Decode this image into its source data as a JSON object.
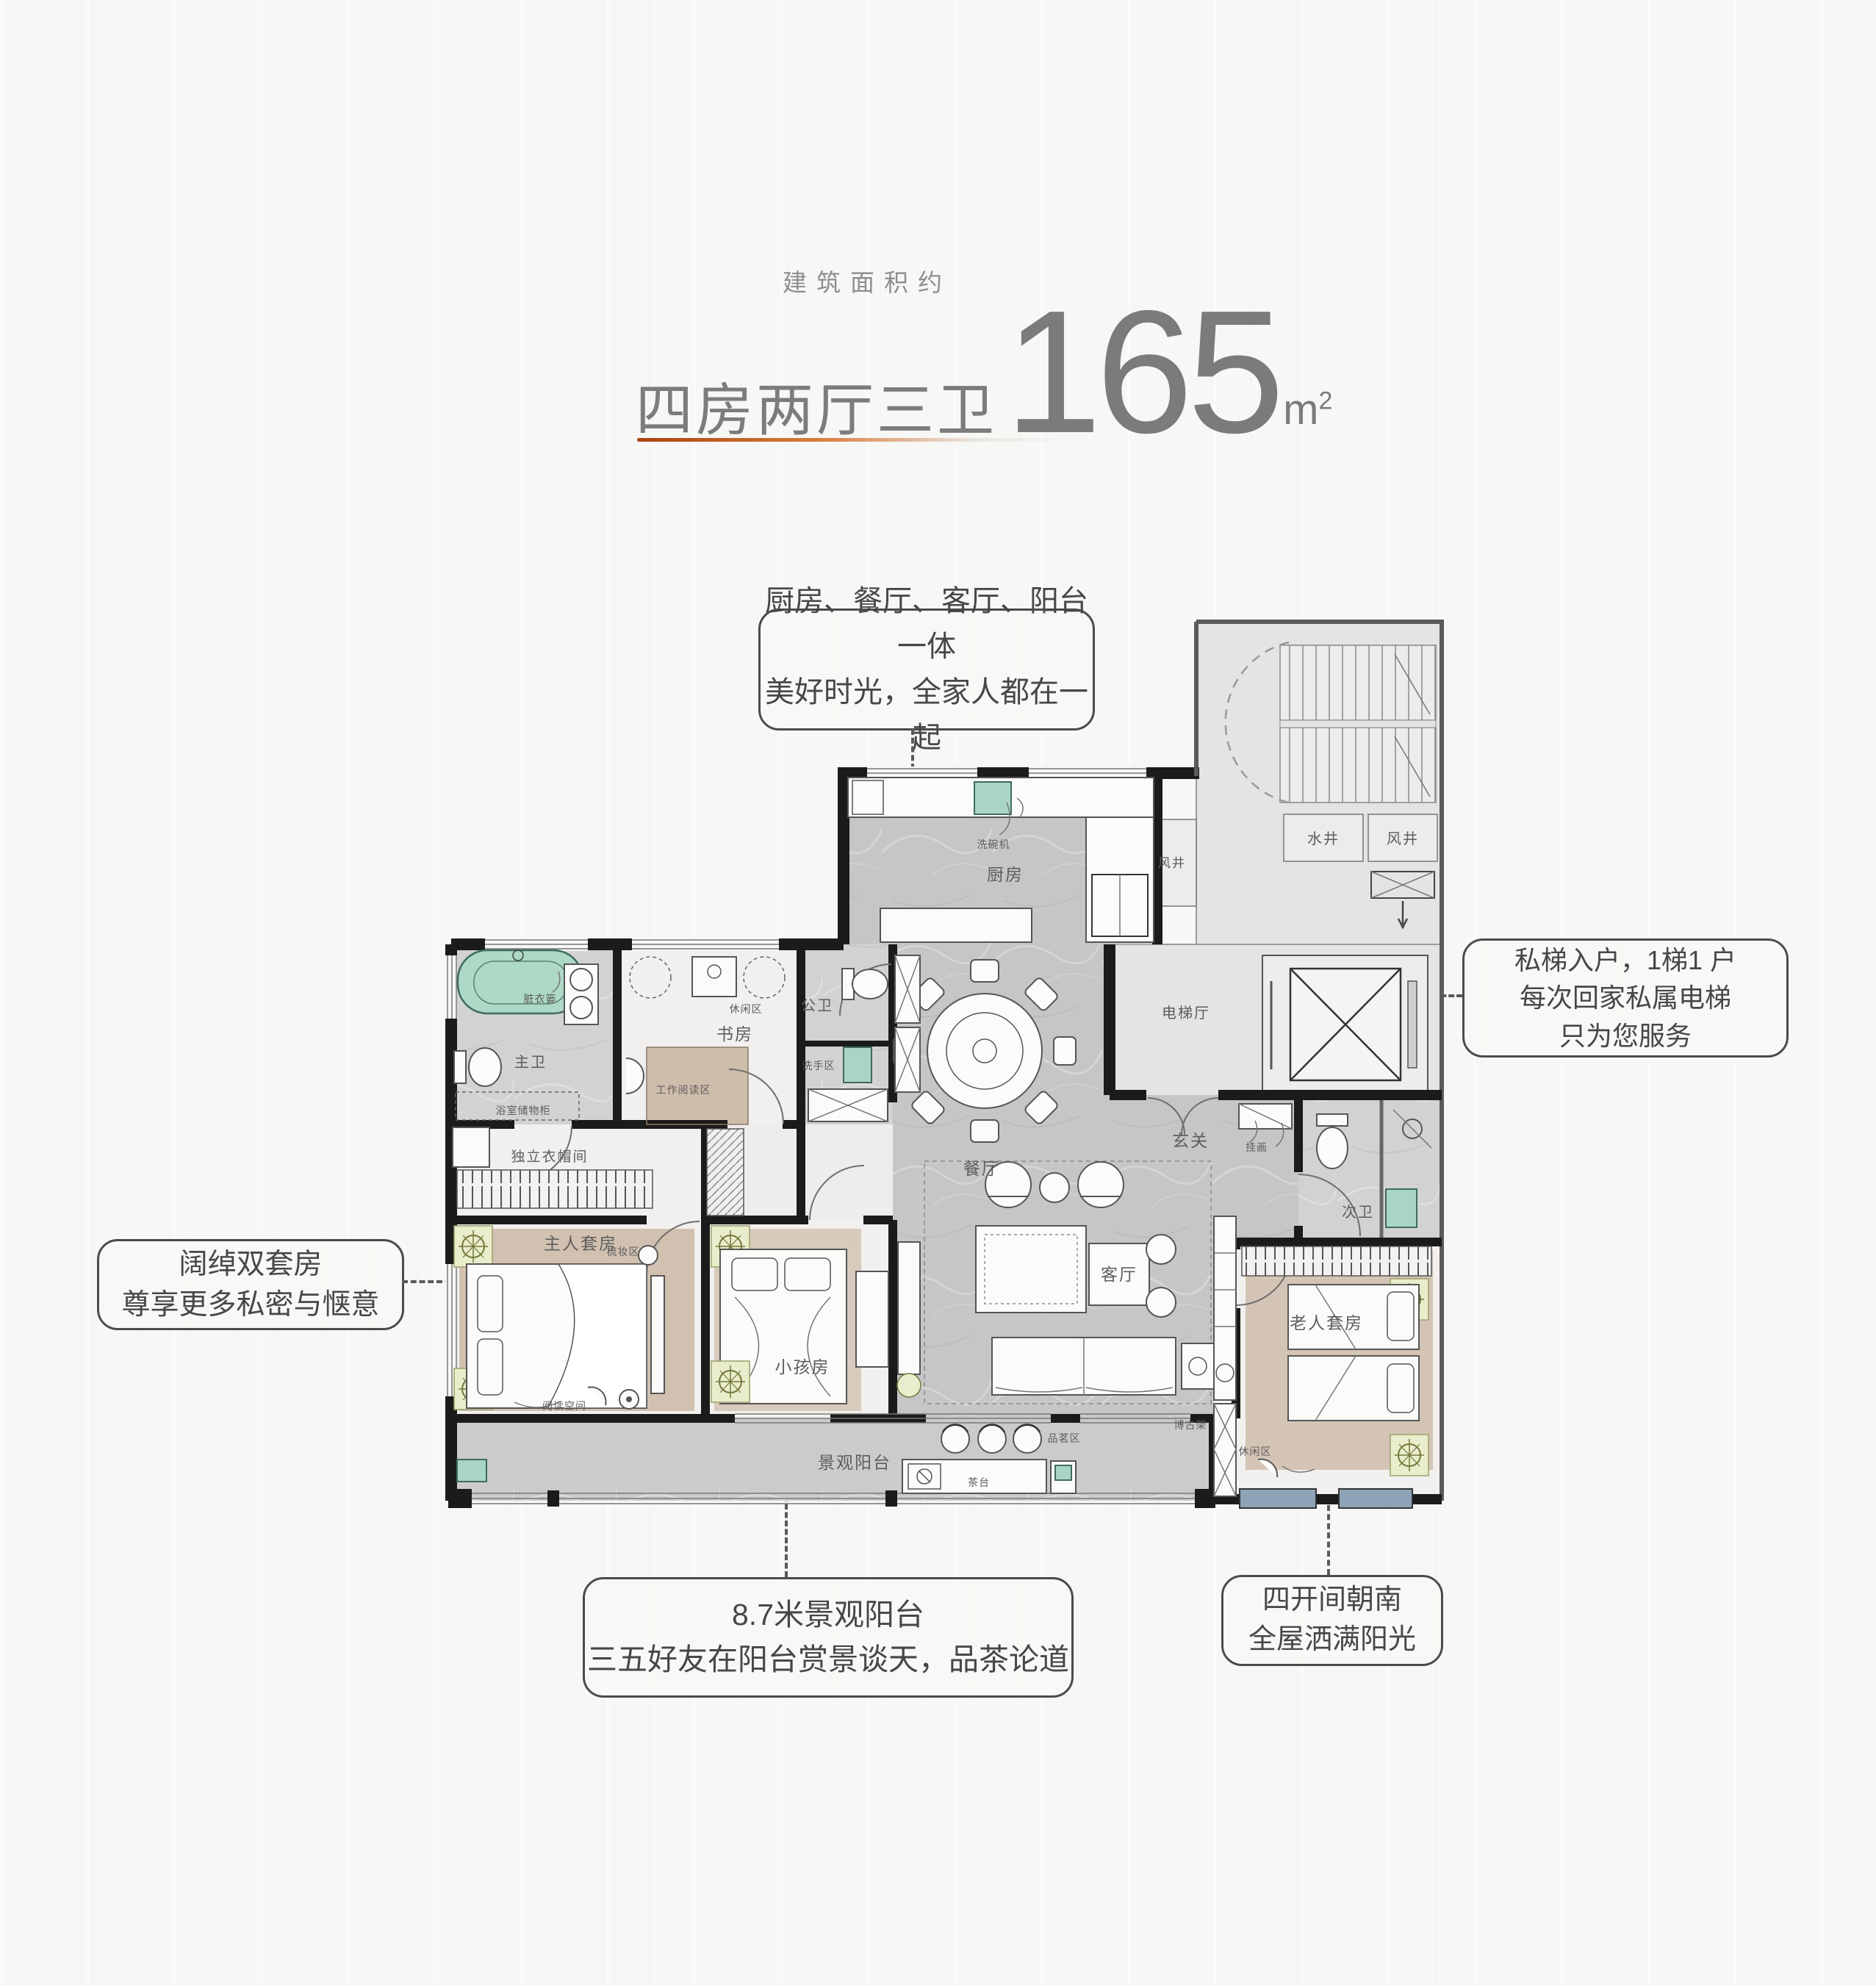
{
  "header": {
    "kicker": "建筑面积约",
    "title": "四房两厅三卫",
    "area_number": "165",
    "area_unit": "m",
    "area_sup": "2",
    "accent_color": "#c4571f",
    "text_color": "#7b7b7b"
  },
  "callouts": {
    "top": {
      "lines": [
        "厨房、餐厅、客厅、阳台一体",
        "美好时光，全家人都在一起"
      ]
    },
    "right": {
      "lines": [
        "私梯入户，1梯1 户",
        "每次回家私属电梯",
        "只为您服务"
      ]
    },
    "left": {
      "lines": [
        "阔绰双套房",
        "尊享更多私密与惬意"
      ]
    },
    "bottom_center": {
      "lines": [
        "8.7米景观阳台",
        "三五好友在阳台赏景谈天，品茶论道"
      ]
    },
    "bottom_right": {
      "lines": [
        "四开间朝南",
        "全屋洒满阳光"
      ]
    }
  },
  "rooms": {
    "kitchen": "厨房",
    "dining": "餐厅",
    "living": "客厅",
    "foyer": "玄关",
    "study": "书房",
    "master_suite": "主人套房",
    "kids_room": "小孩房",
    "elder_suite": "老人套房",
    "master_bath": "主卫",
    "public_bath": "公卫",
    "second_bath": "次卫",
    "closet": "独立衣帽间",
    "balcony": "景观阳台",
    "elevator_hall": "电梯厅",
    "water_shaft": "水井",
    "wind_shaft_a": "风井",
    "wind_shaft_b": "风井"
  },
  "sub_labels": {
    "dishwasher": "洗碗机",
    "leisure_study": "休闲区",
    "work_reading": "工作阅读区",
    "wash_area": "洗手区",
    "laundry_basket": "脏衣篓",
    "bath_cabinet": "浴室储物柜",
    "dressing": "梳妆区",
    "reading_space": "阅读空间",
    "hanging_art": "挂画",
    "tea_table": "茶台",
    "tea_area": "品茗区",
    "display_shelf": "博古架",
    "leisure_elder": "休闲区"
  }
}
